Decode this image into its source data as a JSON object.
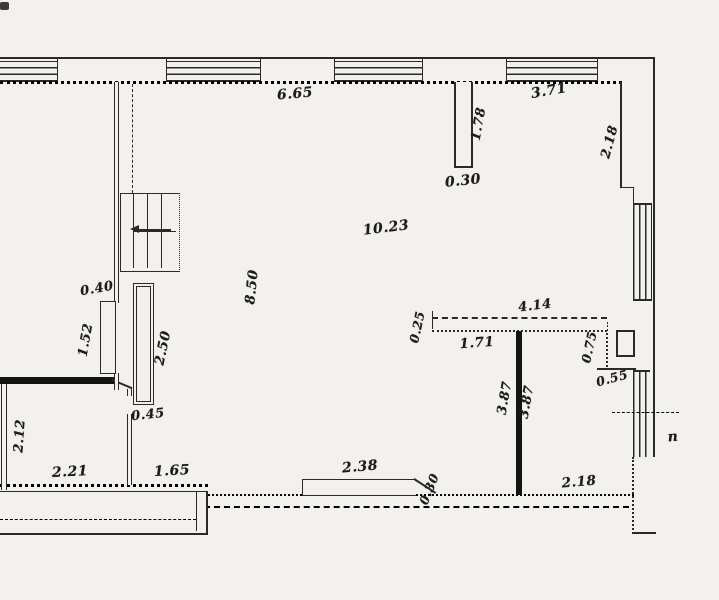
{
  "drawing": {
    "type": "architectural-floor-plan",
    "colors": {
      "ink": "#2b2a28",
      "ink_strong": "#141413",
      "paper": "#f2f1ee"
    },
    "stair_direction_marker": "up-arrow",
    "dimension_labels": [
      {
        "text": "6.65",
        "x": 295,
        "y": 94,
        "rot": -5,
        "size": 14
      },
      {
        "text": "3.71",
        "x": 549,
        "y": 91,
        "rot": -10,
        "size": 14
      },
      {
        "text": "1.78",
        "x": 479,
        "y": 124,
        "rot": -80,
        "size": 13
      },
      {
        "text": "2.18",
        "x": 610,
        "y": 142,
        "rot": -75,
        "size": 13
      },
      {
        "text": "0.30",
        "x": 463,
        "y": 181,
        "rot": -6,
        "size": 14
      },
      {
        "text": "10.23",
        "x": 386,
        "y": 228,
        "rot": -7,
        "size": 14
      },
      {
        "text": "8.50",
        "x": 252,
        "y": 287,
        "rot": -84,
        "size": 13.5
      },
      {
        "text": "0.40",
        "x": 97,
        "y": 289,
        "rot": -10,
        "size": 13
      },
      {
        "text": "1.52",
        "x": 86,
        "y": 340,
        "rot": -80,
        "size": 13
      },
      {
        "text": "2.50",
        "x": 163,
        "y": 348,
        "rot": -78,
        "size": 13.5
      },
      {
        "text": "0.45",
        "x": 148,
        "y": 415,
        "rot": -6,
        "size": 13
      },
      {
        "text": "2.12",
        "x": 20,
        "y": 436,
        "rot": -86,
        "size": 13
      },
      {
        "text": "2.21",
        "x": 70,
        "y": 472,
        "rot": -3,
        "size": 14
      },
      {
        "text": "1.65",
        "x": 172,
        "y": 471,
        "rot": -3,
        "size": 14
      },
      {
        "text": "2.38",
        "x": 360,
        "y": 467,
        "rot": -5,
        "size": 14
      },
      {
        "text": "0.30",
        "x": 429,
        "y": 489,
        "rot": -68,
        "size": 12.5
      },
      {
        "text": "4.14",
        "x": 535,
        "y": 306,
        "rot": -7,
        "size": 13
      },
      {
        "text": "0.25",
        "x": 417,
        "y": 327,
        "rot": -78,
        "size": 12.5
      },
      {
        "text": "1.71",
        "x": 477,
        "y": 343,
        "rot": -4,
        "size": 13.5
      },
      {
        "text": "3.87",
        "x": 505,
        "y": 398,
        "rot": -80,
        "size": 13
      },
      {
        "text": "3.87",
        "x": 527,
        "y": 402,
        "rot": -80,
        "size": 13
      },
      {
        "text": "0.75",
        "x": 589,
        "y": 347,
        "rot": -78,
        "size": 12.5
      },
      {
        "text": "0.55",
        "x": 612,
        "y": 378,
        "rot": -15,
        "size": 12.5
      },
      {
        "text": "2.18",
        "x": 579,
        "y": 482,
        "rot": -5,
        "size": 13.5
      },
      {
        "text": "п",
        "x": 673,
        "y": 437,
        "rot": -5,
        "size": 14
      }
    ]
  }
}
